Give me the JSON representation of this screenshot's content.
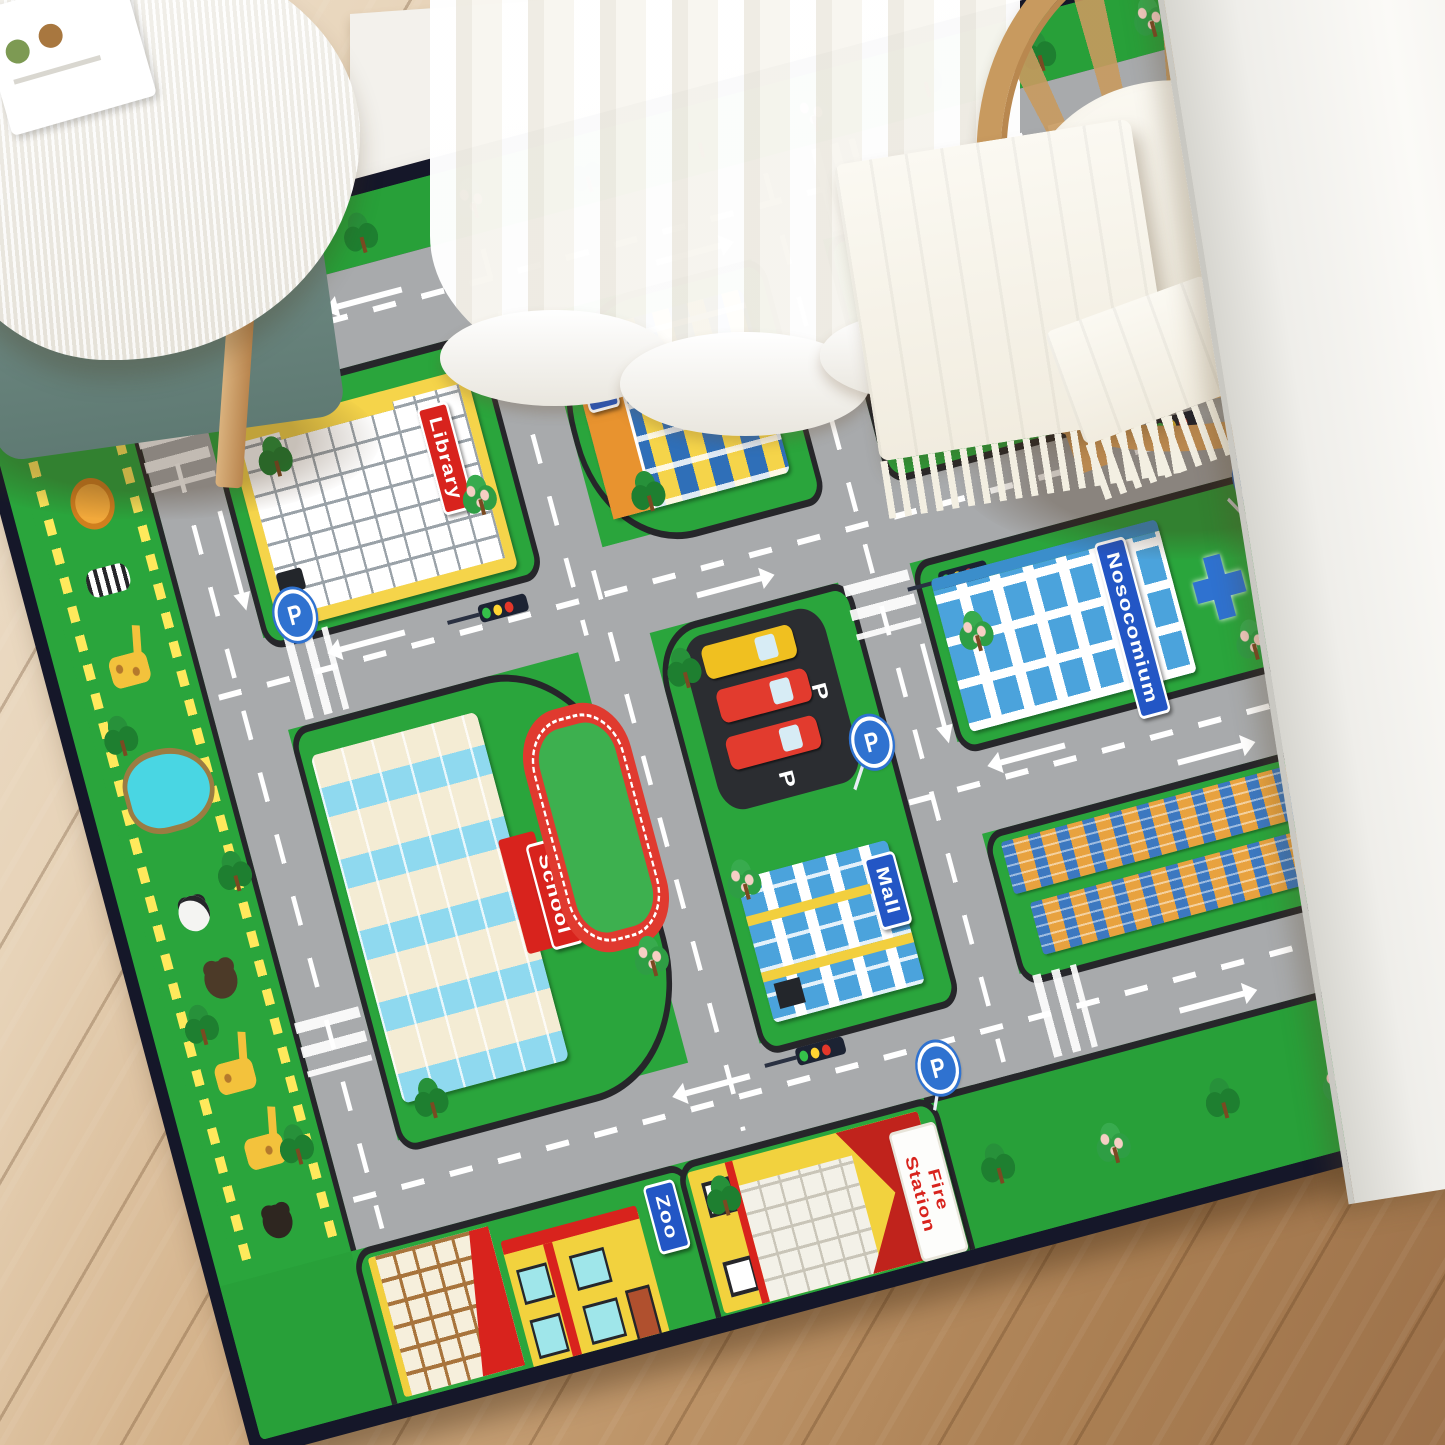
{
  "rug": {
    "signs": {
      "library": "Library",
      "top_right_building": "The P",
      "gas_station": "Gas station",
      "school": "School",
      "hospital": "Nosocomium",
      "mall": "Mall",
      "zoo": "Zoo",
      "plot": "Plot",
      "fire_station": "Fire Station"
    },
    "parking_letter": "P",
    "colors": {
      "grass_green": "#2aa53c",
      "road_gray": "#a8aaac",
      "curb_black": "#26262a",
      "rug_border_navy": "#151729",
      "sign_blue": "#2356c5",
      "sign_red": "#d8231d",
      "track_red": "#e03a2f",
      "building_yellow": "#f5d44a",
      "school_cream": "#f4ecd4",
      "window_blue": "#4ba3dc",
      "plot_orange": "#e8a23f",
      "pond_blue": "#49d6e3"
    }
  },
  "room": {
    "colors": {
      "floor_wood": "#c09467",
      "wall_white": "#f3f1ec",
      "rattan_tan": "#c89a5f",
      "bench_teal": "#76908a",
      "textile_white": "#f8f5ec"
    }
  }
}
